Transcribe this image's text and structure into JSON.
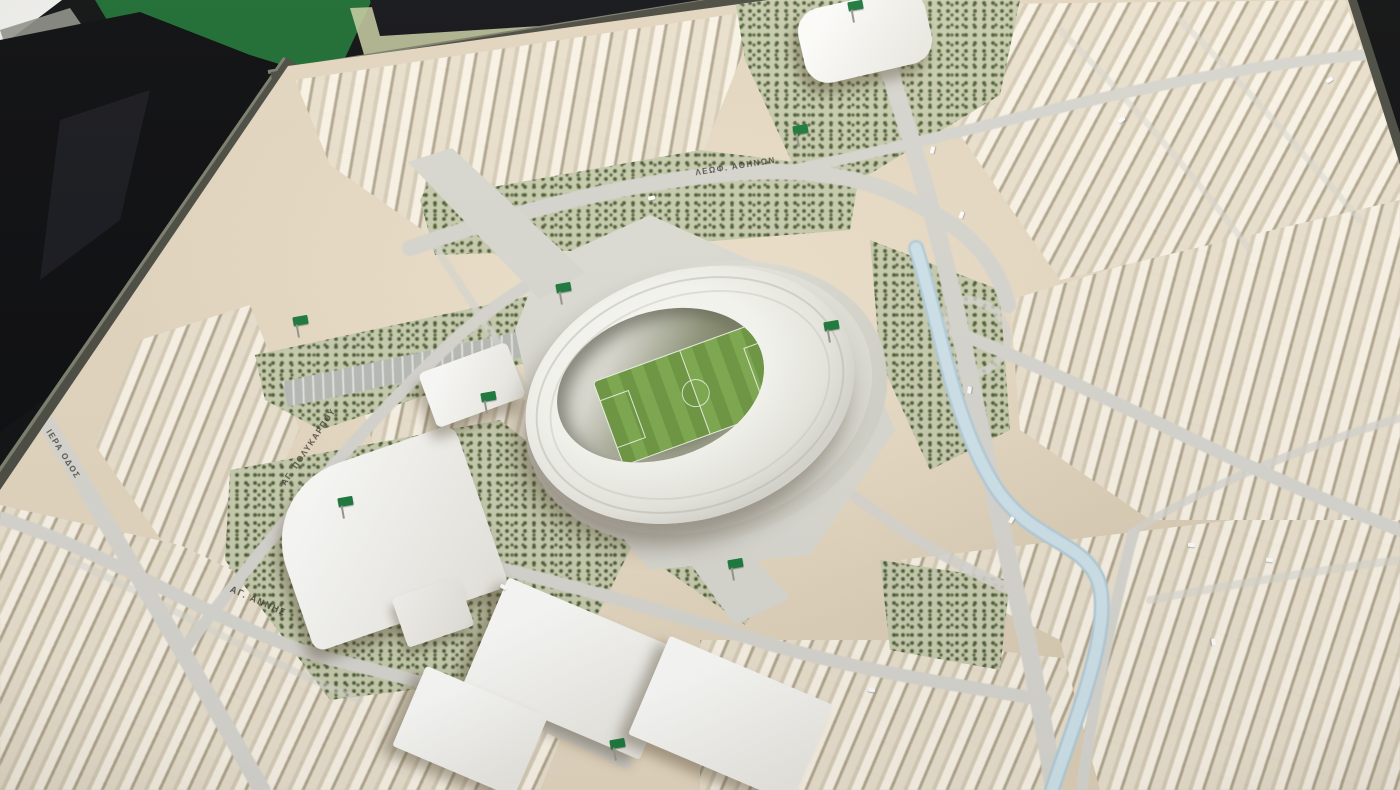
{
  "meta": {
    "description": "Photograph of a physical architectural scale model: a city district masterplan with a white oval football stadium at its centre, tan building blocks, tree-dotted parks, a pale blue canal, grey roads, small green flags on landmark sites, and a dark table/green display board visible at the top-left corner.",
    "subject": "stadium district masterplan scale model"
  },
  "labels": {
    "street_top": "ΛΕΩΦ. ΑΘΗΝΩΝ",
    "street_left": "ΑΓ. ΠΟΛΥΚΑΡΠΟΥ",
    "street_bottom": "ΑΓ. ΑΝΝΗΣ",
    "street_far_left": "ΙΕΡΑ ΟΔΟΣ"
  },
  "colors": {
    "board": "#e3d6c0",
    "road": "#d6d5cf",
    "trees_base": "#c7cbae",
    "tree_dot": "#50603a",
    "water": "#cfe2ea",
    "water_edge": "#b4ccd8",
    "stadium": "#f9f9f6",
    "pitch": "#6d9742",
    "pitch_stripe": "#7ea950",
    "flag_green": "#1d7a3e",
    "frame": "#4b4c43",
    "side_panel_green": "#1e6c33",
    "background_black": "#0c0d10",
    "esplanade": "#dcdcd6",
    "building_white": "#f4f3ef"
  },
  "model": {
    "flags": [
      {
        "x": 293,
        "y": 316
      },
      {
        "x": 556,
        "y": 283
      },
      {
        "x": 481,
        "y": 392
      },
      {
        "x": 338,
        "y": 497
      },
      {
        "x": 824,
        "y": 321
      },
      {
        "x": 793,
        "y": 125
      },
      {
        "x": 728,
        "y": 559
      },
      {
        "x": 610,
        "y": 739
      },
      {
        "x": 848,
        "y": 1
      }
    ],
    "cars": [
      {
        "x": 958,
        "y": 213,
        "a": -70
      },
      {
        "x": 929,
        "y": 148,
        "a": -75
      },
      {
        "x": 966,
        "y": 388,
        "a": -82
      },
      {
        "x": 1008,
        "y": 518,
        "a": -60
      },
      {
        "x": 1188,
        "y": 543,
        "a": 6
      },
      {
        "x": 1266,
        "y": 558,
        "a": 8
      },
      {
        "x": 1118,
        "y": 118,
        "a": -35
      },
      {
        "x": 1326,
        "y": 78,
        "a": -32
      },
      {
        "x": 868,
        "y": 688,
        "a": 10
      },
      {
        "x": 648,
        "y": 196,
        "a": -14
      },
      {
        "x": 1210,
        "y": 640,
        "a": 80
      },
      {
        "x": 500,
        "y": 585,
        "a": 28
      }
    ]
  }
}
